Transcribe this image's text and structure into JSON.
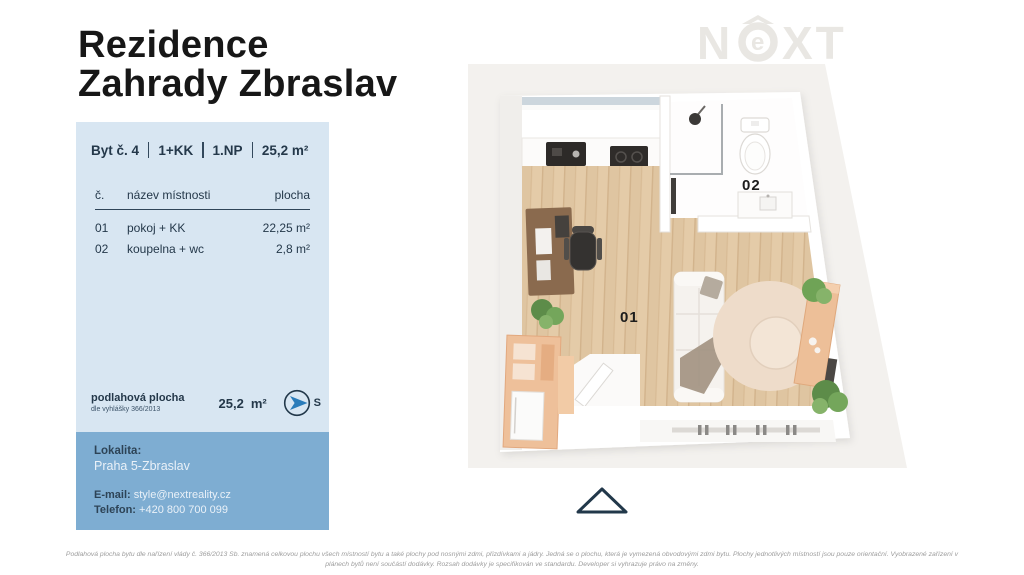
{
  "title": {
    "line1": "Rezidence",
    "line2": "Zahrady Zbraslav"
  },
  "logo": {
    "n": "N",
    "e": "e",
    "xt": "XT"
  },
  "unit": {
    "segments": [
      "Byt č. 4",
      "1+KK",
      "1.NP",
      "25,2 m²"
    ]
  },
  "rooms": {
    "headers": {
      "num": "č.",
      "name": "název místnosti",
      "area": "plocha"
    },
    "rows": [
      {
        "num": "01",
        "name": "pokoj + KK",
        "area": "22,25 m²"
      },
      {
        "num": "02",
        "name": "koupelna + wc",
        "area": "2,8 m²"
      }
    ]
  },
  "floor_area": {
    "label": "podlahová plocha",
    "sublabel": "dle vyhlášky 366/2013",
    "value": "25,2",
    "unit": "m²",
    "compass_letter": "S"
  },
  "contact": {
    "location_label": "Lokalita:",
    "location": "Praha 5-Zbraslav",
    "email_label": "E-mail:",
    "email": "style@nextreality.cz",
    "phone_label": "Telefon:",
    "phone": "+420 800 700 099"
  },
  "plan": {
    "room1_label": "01",
    "room2_label": "02"
  },
  "disclaimer": {
    "line1": "Podlahová plocha bytu dle nařízení vlády č. 366/2013 Sb. znamená celkovou plochu všech místností bytu a také plochy pod nosnými zdmi, přizdívkami a jádry. Jedná se o plochu, která je vymezená obvodovými zdmi bytu. Plochy jednotlivých místností jsou pouze orientační. Vyobrazené zařízení v",
    "line2": "plánech bytů není součástí dodávky. Rozsah dodávky je specifikován ve standardu. Developer si vyhrazuje právo na změny."
  },
  "colors": {
    "panel_light_blue": "#d8e6f2",
    "panel_blue": "#7eadd2",
    "navy_text": "#24384a",
    "compass_arrow_blue": "#2a7cba",
    "wood_floor": "#dfc5a1",
    "furniture_peach": "#eec09a",
    "logo_gray": "#e9e7e3"
  }
}
